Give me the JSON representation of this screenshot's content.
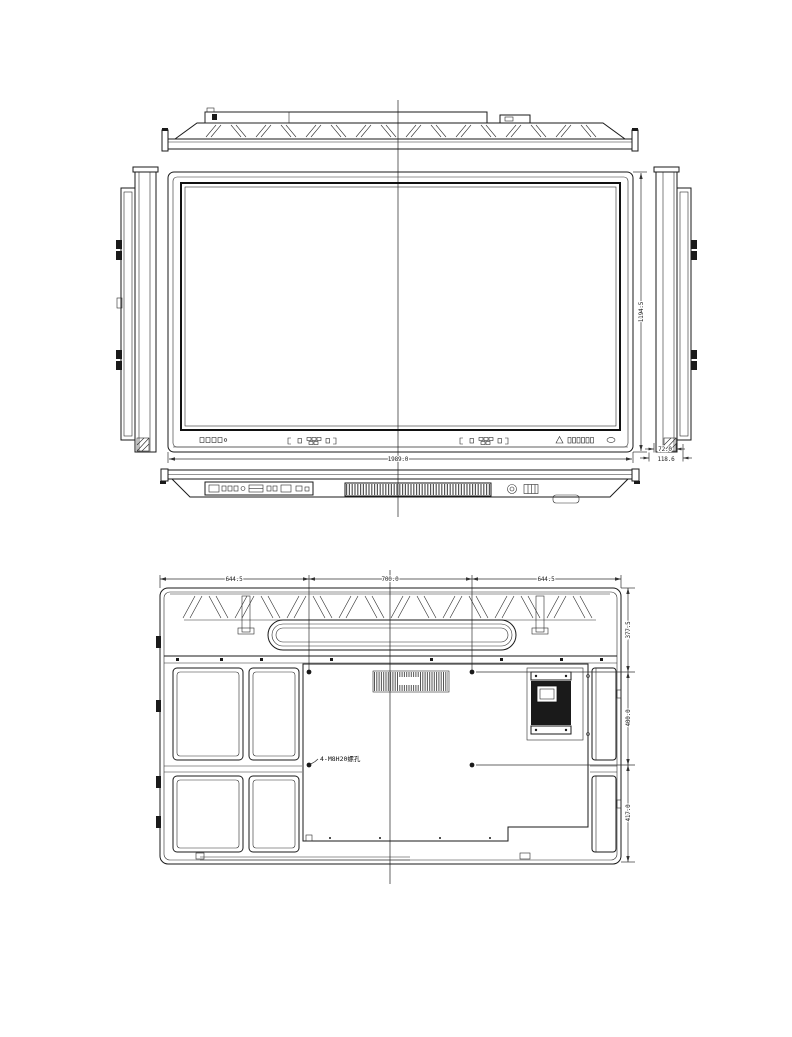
{
  "colors": {
    "line": "#1a1a1a",
    "dimension": "#333333",
    "background": "#ffffff"
  },
  "dimensions": {
    "overall_width": "1989.0",
    "overall_height": "1194.5",
    "depth_body": "72.0",
    "depth_total": "118.6",
    "rear_top_left": "644.5",
    "rear_top_center": "700.0",
    "rear_top_right": "644.5",
    "rear_right_top": "377.5",
    "rear_right_middle": "400.0",
    "rear_right_bottom": "417.0"
  },
  "annotations": {
    "vesa_holes": "4-M8H20螺孔"
  }
}
